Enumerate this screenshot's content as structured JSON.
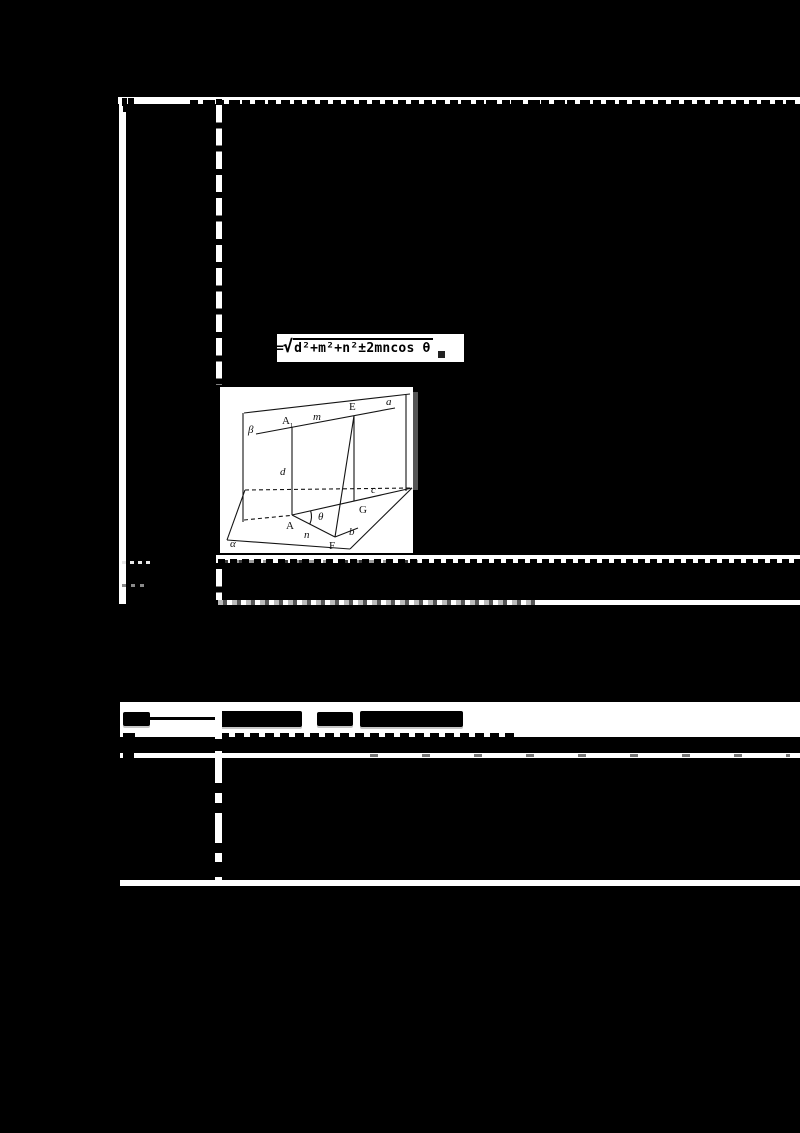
{
  "document": {
    "type": "scanned-table-page",
    "visible_text": {
      "formula": {
        "equals": "=",
        "radical_sign": "√",
        "radicand": "d²+m²+n²±2mncos θ",
        "period": "。"
      },
      "figure_labels": {
        "beta": "β",
        "a_line": "a",
        "A1_base": "A",
        "A1_sub": "1",
        "m": "m",
        "E": "E",
        "d": "d",
        "c": "c",
        "A": "A",
        "theta": "θ",
        "G": "G",
        "n": "n",
        "F": "F",
        "b": "b",
        "alpha": "α"
      }
    },
    "colors": {
      "page_background": "#000000",
      "paper": "#ffffff",
      "ink": "#000000",
      "speckle_gray": "#9a9a9a"
    }
  }
}
